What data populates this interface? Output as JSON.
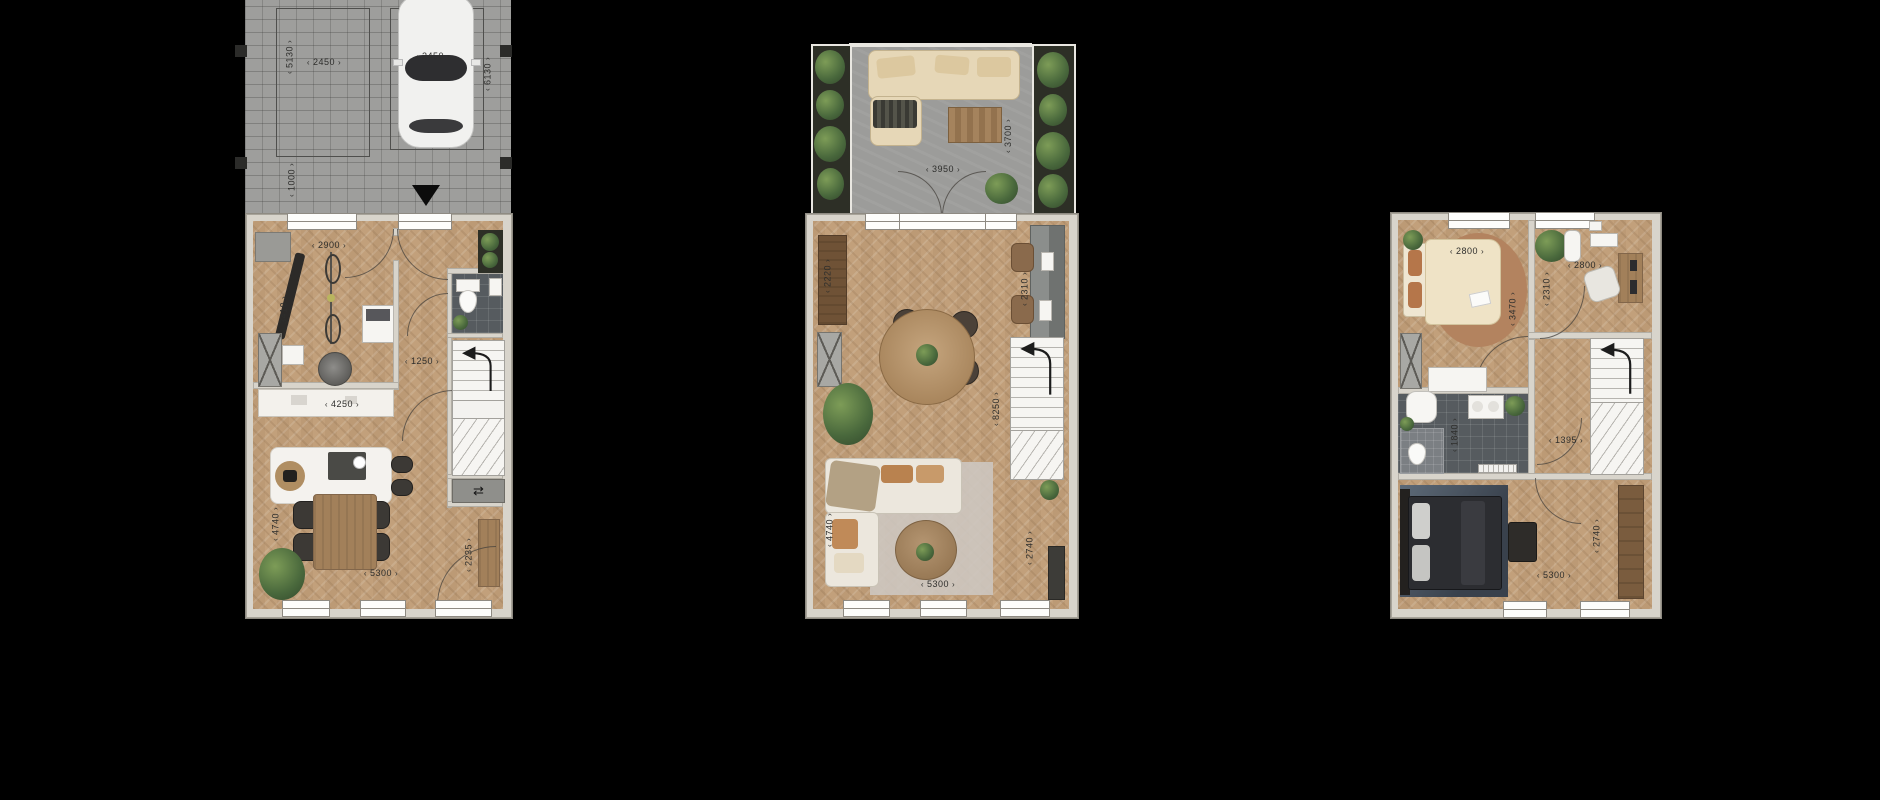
{
  "scene": {
    "background_color": "#000000",
    "type": "residential-floor-plans",
    "accent_colors": {
      "wall": "#d8d4cb",
      "wood_floor": "#c2a07b",
      "pavement": "#9e9e9c",
      "dark_tile": "#565b5f",
      "label_text": "#2e2e2c"
    }
  },
  "icons": {
    "entrance_arrow": "▼",
    "meter_symbol": "⇄"
  },
  "floor_plans": [
    {
      "id": "ground-floor-with-driveway",
      "dimensions": {
        "parking_left_depth": "5130",
        "parking_left_width": "2450",
        "walkway": "1000",
        "parking_right_width": "2450",
        "parking_right_depth": "6130",
        "storage_width": "2900",
        "storage_depth": "3410",
        "hall_width": "1250",
        "counter_width": "4250",
        "dining_depth": "4740",
        "living_width": "5300",
        "entry_depth": "2235"
      }
    },
    {
      "id": "living-floor-with-terrace",
      "dimensions": {
        "terrace_depth": "3700",
        "terrace_width": "3950",
        "left_wall": "2220",
        "kitchen_depth": "2310",
        "room_depth": "8250",
        "sofa_depth": "4740",
        "right_depth": "2740",
        "room_width": "5300"
      }
    },
    {
      "id": "bedroom-floor",
      "dimensions": {
        "bedroom1_width": "2800",
        "bedroom1_depth": "3470",
        "bedroom2_width": "2800",
        "bedroom2_depth": "2310",
        "bathroom_depth": "1840",
        "landing_width": "1395",
        "bedroom3_depth": "2740",
        "bedroom3_width": "5300"
      }
    }
  ]
}
